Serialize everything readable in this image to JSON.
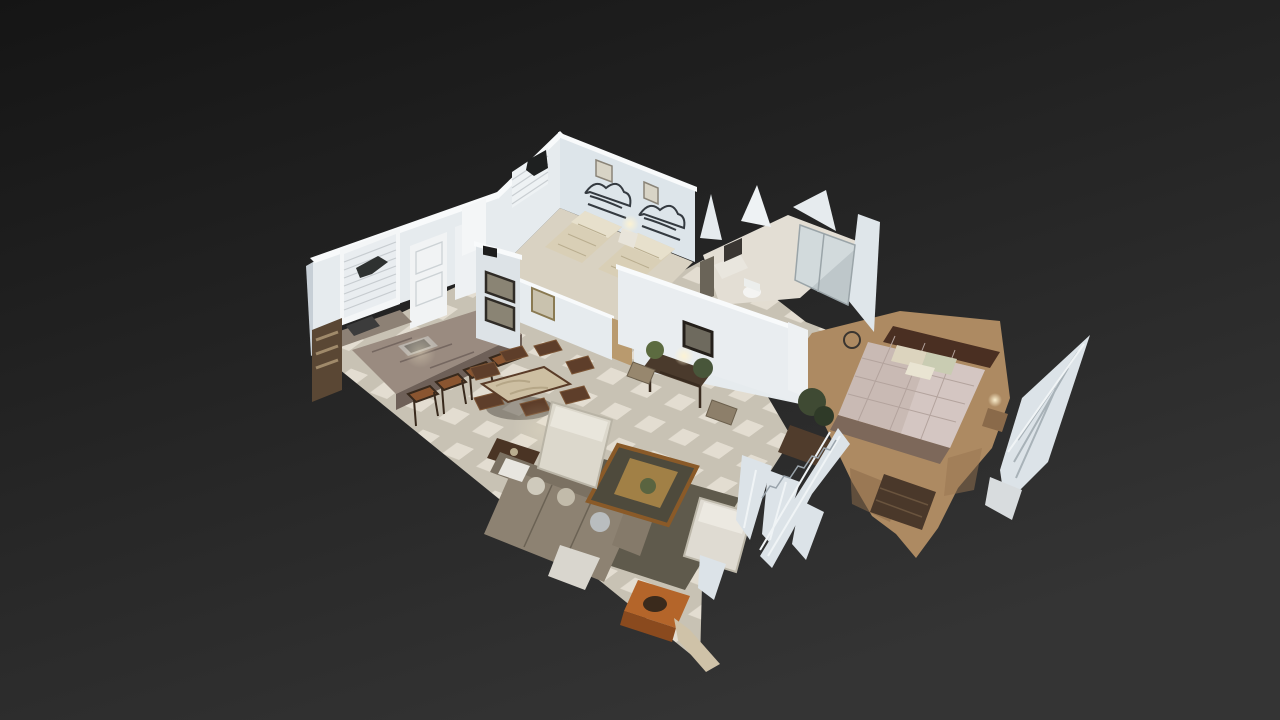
{
  "viewer": {
    "mode": "dollhouse-3d-view",
    "background_top": "#151515",
    "background_bottom": "#343434"
  },
  "palette": {
    "wall_lit": "#e6ebee",
    "wall_bright": "#f8fafb",
    "wall_shadow": "#c7cfd6",
    "tile": "#e3ddd1",
    "tile_line": "#c8c2b4",
    "guest_floor": "#d9d2c2",
    "carpet": "#ad8a62",
    "artifact": "#dce3e8",
    "artifact_streak": "#f0f4f6",
    "wood_dark": "#5e3e2a",
    "rug": "#5f5a4c",
    "sofa": "#8d8272",
    "quilt": "#c9bab4",
    "bedspread": "#d9cfb6",
    "lamp_glow": "#f8edd0"
  },
  "scene": {
    "description": "cutaway dollhouse model of a single-level home",
    "rooms": [
      {
        "id": "kitchen",
        "contents": [
          "window-blinds",
          "panel-door",
          "open-door",
          "breakfast-bar",
          "sink",
          "range",
          "bar-stools",
          "shelf-unit"
        ]
      },
      {
        "id": "dining-area",
        "contents": [
          "dining-table",
          "dining-chairs",
          "framed-art",
          "wall-keypad"
        ]
      },
      {
        "id": "living-room",
        "contents": [
          "sofa",
          "recliner",
          "wing-chair",
          "coffee-table",
          "area-rug",
          "end-table",
          "console-table",
          "table-lamp",
          "wall-mirror",
          "houseplants",
          "ottomans",
          "armoire"
        ]
      },
      {
        "id": "guest-bedroom",
        "contents": [
          "twin-bed",
          "twin-bed",
          "iron-headboard",
          "iron-headboard",
          "nightstand",
          "window-blinds",
          "framed-art"
        ]
      },
      {
        "id": "bathroom",
        "contents": [
          "shower-enclosure",
          "toilet",
          "vanity",
          "mirror"
        ]
      },
      {
        "id": "master-bedroom",
        "contents": [
          "double-bed",
          "pillows",
          "wood-headboard",
          "nightstand",
          "dresser",
          "carpet",
          "scan-artifact-shards"
        ]
      }
    ]
  }
}
